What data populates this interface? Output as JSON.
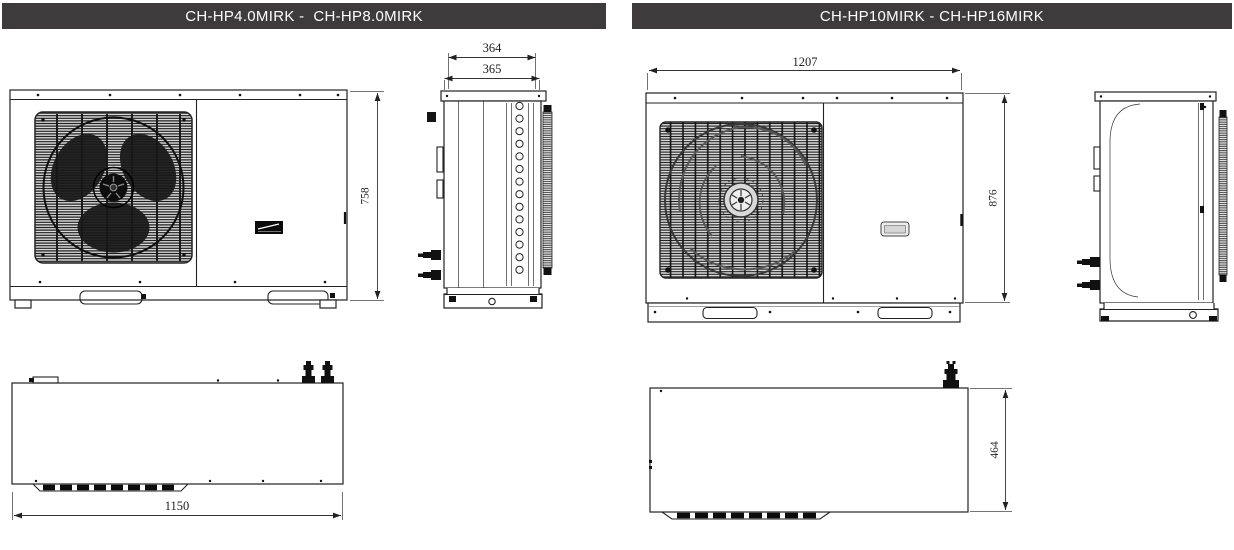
{
  "panels": [
    {
      "title": "CH-HP4.0MIRK -  CH-HP8.0MIRK",
      "front": {
        "height": "758"
      },
      "side": {
        "depth_outer": "364",
        "depth_inner": "365"
      },
      "top": {
        "width": "1150"
      }
    },
    {
      "title": "CH-HP10MIRK - CH-HP16MIRK",
      "front": {
        "width": "1207",
        "height": "876"
      },
      "top": {
        "depth": "464"
      }
    }
  ],
  "colors": {
    "header_bg": "#3d3b3c",
    "line": "#222222"
  }
}
